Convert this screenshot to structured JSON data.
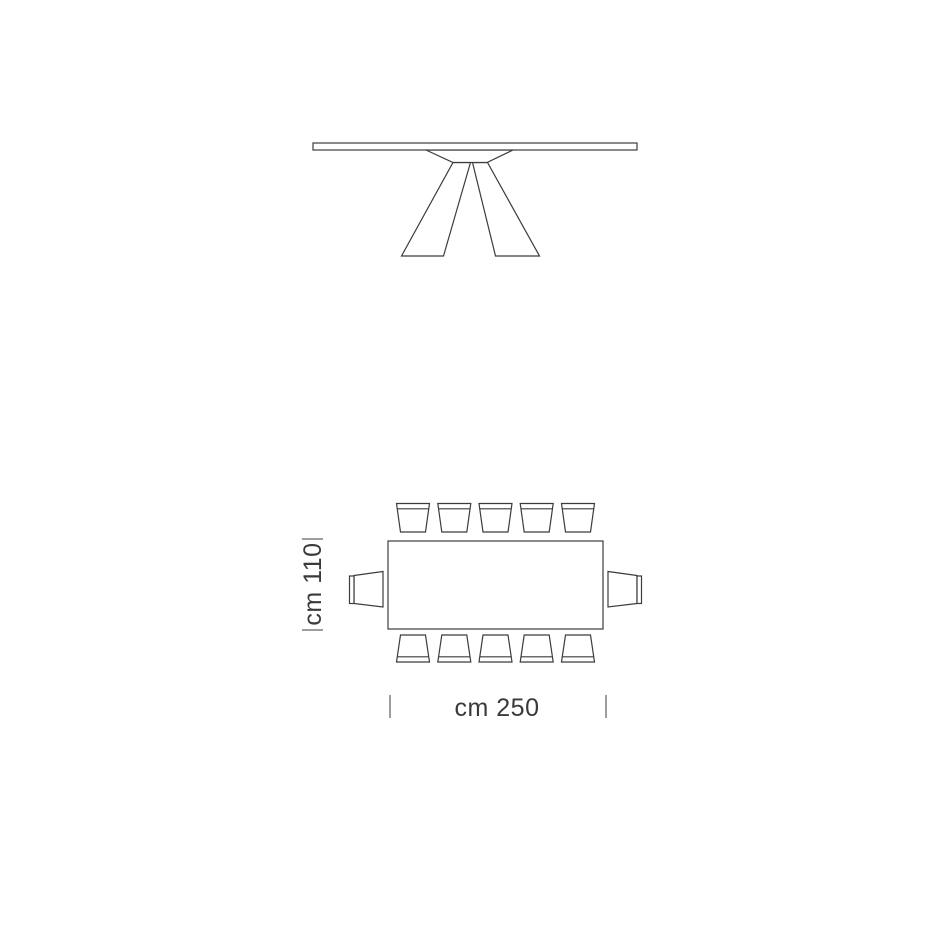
{
  "colors": {
    "background": "#ffffff",
    "line": "#3c3c3c",
    "tick": "#9e9e9e",
    "text": "#3a3a3a"
  },
  "dimensions": {
    "depth_label": "cm 110",
    "length_label": "cm 250"
  },
  "plan": {
    "chairs_top": 5,
    "chairs_bottom": 5,
    "chairs_left": 1,
    "chairs_right": 1,
    "chairs_total": 12
  }
}
